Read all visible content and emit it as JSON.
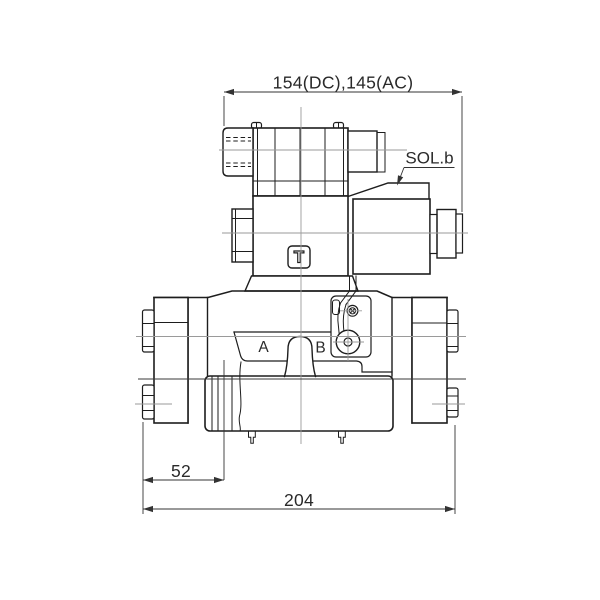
{
  "drawing": {
    "top_dimension": "154(DC),145(AC)",
    "solenoid_label": "SOL.b",
    "port_a": "A",
    "port_b": "B",
    "dim_left": "52",
    "dim_overall": "204",
    "logo": "T"
  },
  "colors": {
    "background": "#ffffff",
    "outline": "#1d1d1d",
    "centerline": "#9a9a9a",
    "dimension": "#333333"
  }
}
